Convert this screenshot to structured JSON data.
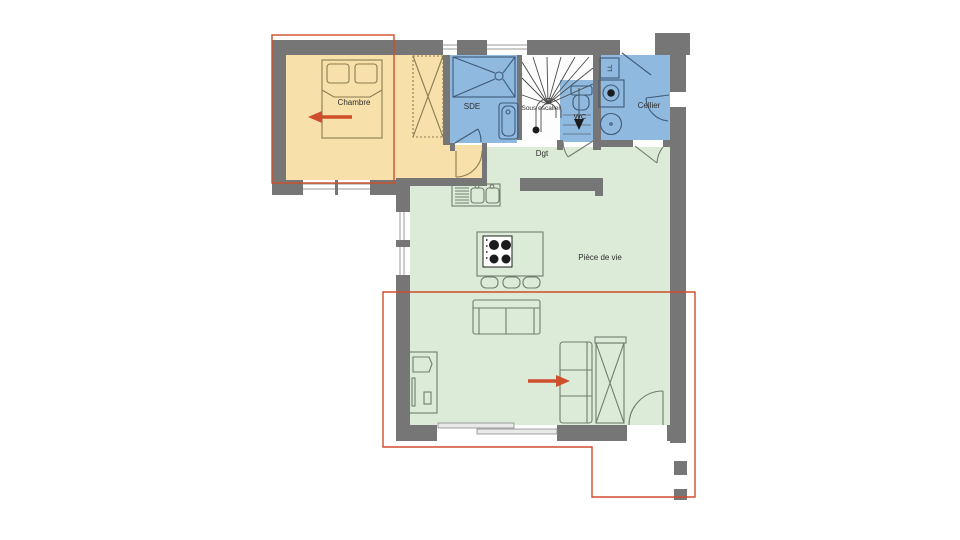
{
  "palette": {
    "wall": "#767676",
    "bedroom": "#f7e0a9",
    "wet": "#8fb9de",
    "living": "#dcebd8",
    "accent": "#cf4e2b",
    "outline-tan": "#8a7c55",
    "outline-blue": "#3e5a78",
    "outline-green": "#6f7c6e",
    "text": "#2e2e2e"
  },
  "rooms": {
    "chambre": {
      "label": "Chambre"
    },
    "sde": {
      "label": "SDE"
    },
    "sous_escalier": {
      "label": "Sous escalier"
    },
    "wc": {
      "label": "WC"
    },
    "ll": {
      "label": "LL"
    },
    "cellier": {
      "label": "Cellier"
    },
    "dgt": {
      "label": "Dgt"
    },
    "piece_de_vie": {
      "label": "Pièce de vie"
    }
  }
}
